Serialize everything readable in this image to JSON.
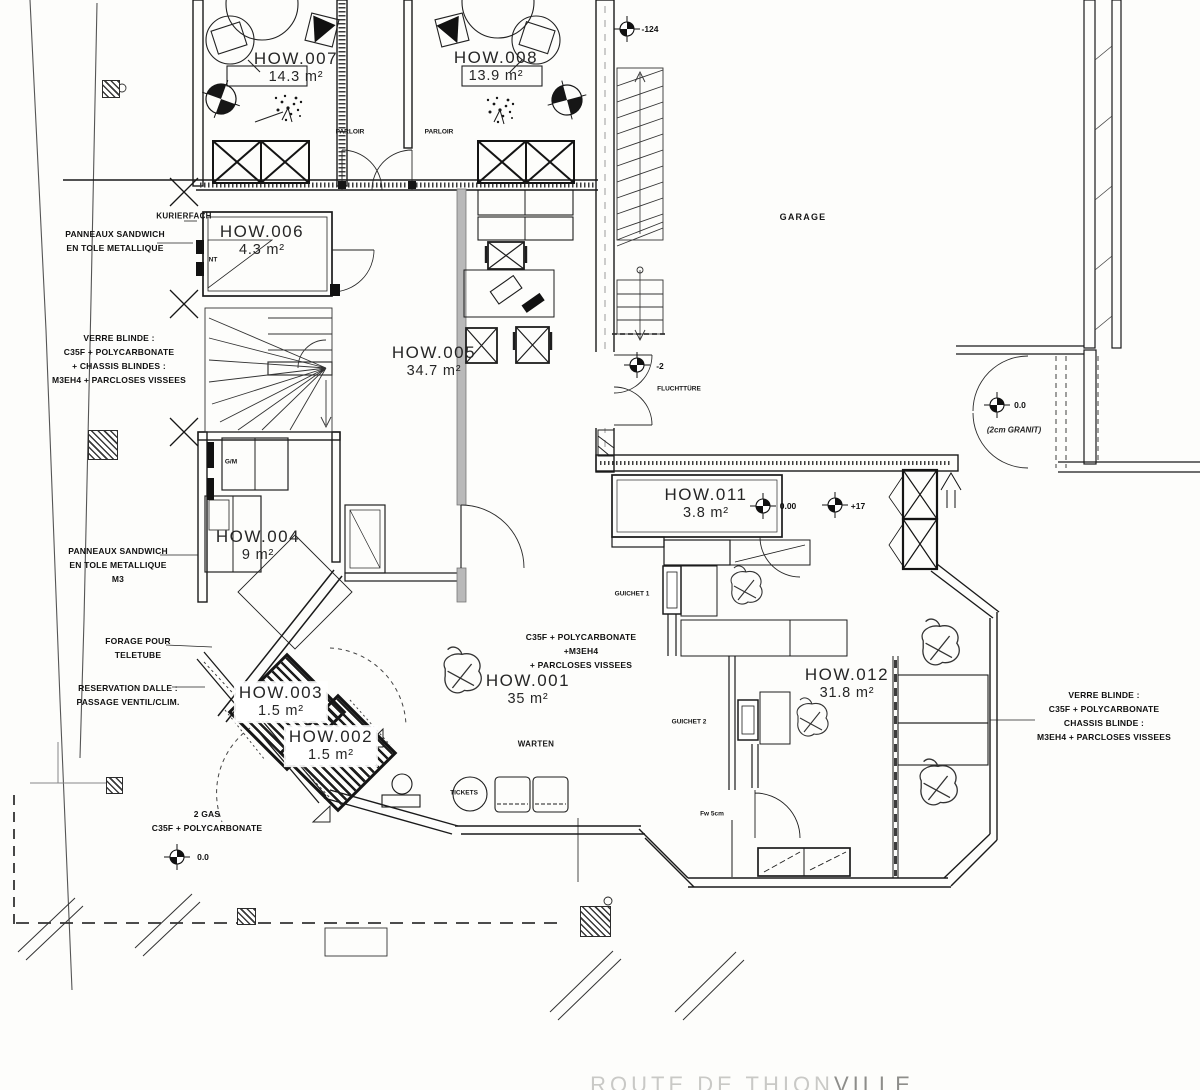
{
  "drawing": {
    "street": {
      "part1": "ROUTE DE THION",
      "part2": "VILLE"
    }
  },
  "rooms": {
    "how001": {
      "id": "HOW.001",
      "area": "35 m²"
    },
    "how002": {
      "id": "HOW.002",
      "area": "1.5 m²"
    },
    "how003": {
      "id": "HOW.003",
      "area": "1.5 m²"
    },
    "how004": {
      "id": "HOW.004",
      "area": "9 m²"
    },
    "how005": {
      "id": "HOW.005",
      "area": "34.7 m²"
    },
    "how006": {
      "id": "HOW.006",
      "area": "4.3 m²"
    },
    "how007": {
      "id": "HOW.007",
      "area": "14.3 m²"
    },
    "how008": {
      "id": "HOW.008",
      "area": "13.9 m²"
    },
    "how011": {
      "id": "HOW.011",
      "area": "3.8 m²"
    },
    "how012": {
      "id": "HOW.012",
      "area": "31.8 m²"
    }
  },
  "zones": {
    "garage": "GARAGE",
    "parloir": "PARLOIR",
    "kurierfach": "KURIERFACH",
    "warten": "WARTEN",
    "tickets": "TICKETS",
    "guichet1": "GUICHET 1",
    "guichet2": "GUICHET 2",
    "fluchtture": "FLUCHTTÜRE",
    "nt": "NT",
    "gm": "G/M",
    "fw": "Fw 5cm"
  },
  "levels": {
    "garage_top": "-124",
    "flucht": "-2",
    "how011": "0.00",
    "passage": "+17",
    "granit": "0.0",
    "granit_note": "(2cm GRANIT)",
    "parvis": "0.0"
  },
  "annotations": {
    "panneaux_nord": [
      "PANNEAUX SANDWICH",
      "EN TOLE METALLIQUE"
    ],
    "verre_ouest": [
      "VERRE BLINDE :",
      "C35F + POLYCARBONATE",
      "+ CHASSIS BLINDES :",
      "M3EH4 + PARCLOSES VISSEES"
    ],
    "panneaux_ouest": [
      "PANNEAUX SANDWICH",
      "EN TOLE METALLIQUE",
      "M3"
    ],
    "forage": [
      "FORAGE POUR",
      "TELETUBE"
    ],
    "reservation": [
      "RESERVATION DALLE :",
      "PASSAGE VENTIL/CLIM."
    ],
    "gas": [
      "2 GAS",
      "C35F + POLYCARBONATE"
    ],
    "vitrage_hall": [
      "C35F + POLYCARBONATE",
      "+M3EH4",
      "+ PARCLOSES VISSEES"
    ],
    "verre_est": [
      "VERRE BLINDE :",
      "C35F + POLYCARBONATE",
      "CHASSIS BLINDE :",
      "M3EH4 + PARCLOSES VISSEES"
    ]
  }
}
